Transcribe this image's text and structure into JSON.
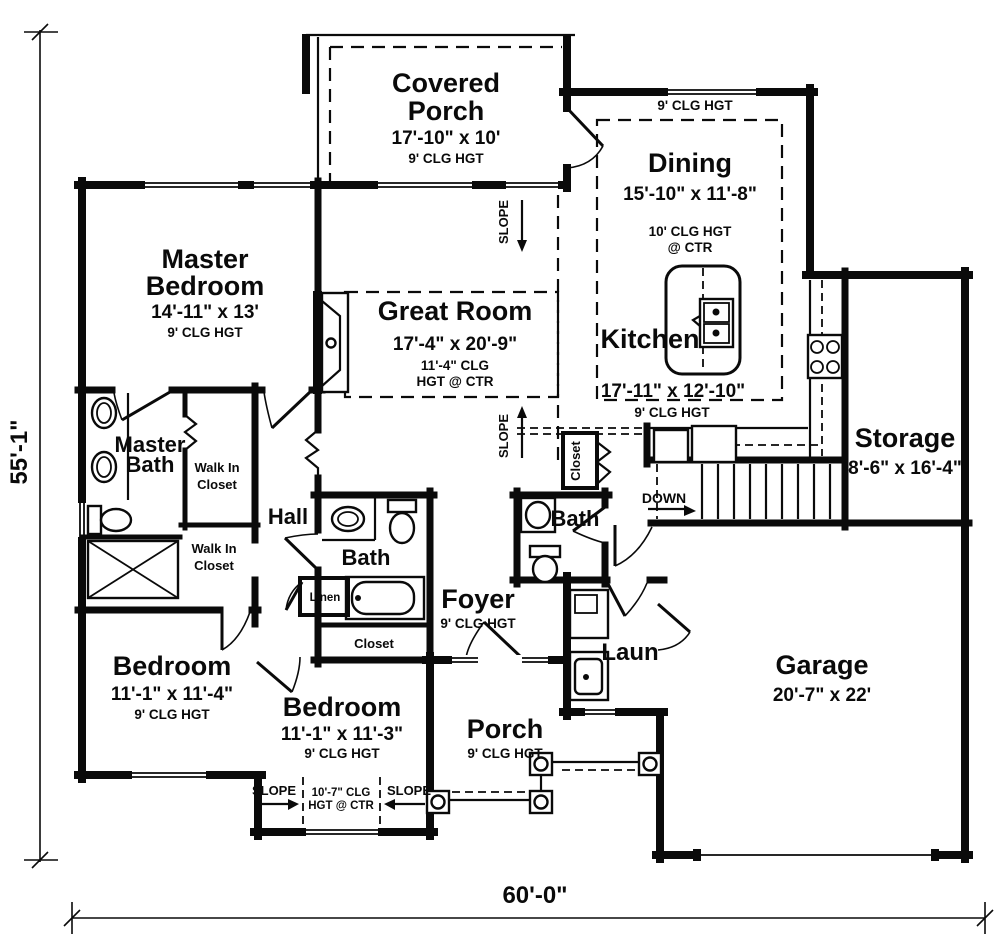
{
  "dim": {
    "height": "55'-1\"",
    "width": "60'-0\""
  },
  "rooms": {
    "covered_porch": {
      "l1": "Covered",
      "l2": "Porch",
      "size": "17'-10\" x 10'",
      "clg": "9' CLG HGT"
    },
    "dining": {
      "name": "Dining",
      "size": "15'-10\" x 11'-8\"",
      "clg1": "10' CLG HGT",
      "clg2": "@ CTR",
      "top_clg": "9' CLG HGT"
    },
    "kitchen": {
      "name": "Kitchen",
      "size": "17'-11\" x 12'-10\"",
      "clg": "9' CLG HGT"
    },
    "great_room": {
      "name": "Great Room",
      "size": "17'-4\" x 20'-9\"",
      "clg1": "11'-4\" CLG",
      "clg2": "HGT @ CTR"
    },
    "master_bedroom": {
      "l1": "Master",
      "l2": "Bedroom",
      "size": "14'-11\" x 13'",
      "clg": "9' CLG HGT"
    },
    "master_bath": {
      "l1": "Master",
      "l2": "Bath"
    },
    "wic1": {
      "l1": "Walk In",
      "l2": "Closet"
    },
    "wic2": {
      "l1": "Walk In",
      "l2": "Closet"
    },
    "hall": {
      "name": "Hall"
    },
    "bath1": {
      "name": "Bath"
    },
    "bath2": {
      "name": "Bath"
    },
    "linen": {
      "name": "Linen"
    },
    "closet1": {
      "name": "Closet"
    },
    "closet2": {
      "name": "Closet"
    },
    "foyer": {
      "name": "Foyer",
      "clg": "9' CLG HGT"
    },
    "laundry": {
      "name": "Laun"
    },
    "storage": {
      "name": "Storage",
      "size": "8'-6\" x 16'-4\""
    },
    "garage": {
      "name": "Garage",
      "size": "20'-7\" x 22'"
    },
    "bedroom1": {
      "name": "Bedroom",
      "size": "11'-1\" x 11'-4\"",
      "clg": "9' CLG HGT"
    },
    "bedroom2": {
      "name": "Bedroom",
      "size": "11'-1\" x 11'-3\"",
      "clg": "9' CLG HGT",
      "ctr_clg1": "10'-7\" CLG",
      "ctr_clg2": "HGT @ CTR"
    },
    "porch": {
      "name": "Porch",
      "clg": "9' CLG HGT"
    }
  },
  "annotations": {
    "slope": "SLOPE",
    "down": "DOWN"
  }
}
